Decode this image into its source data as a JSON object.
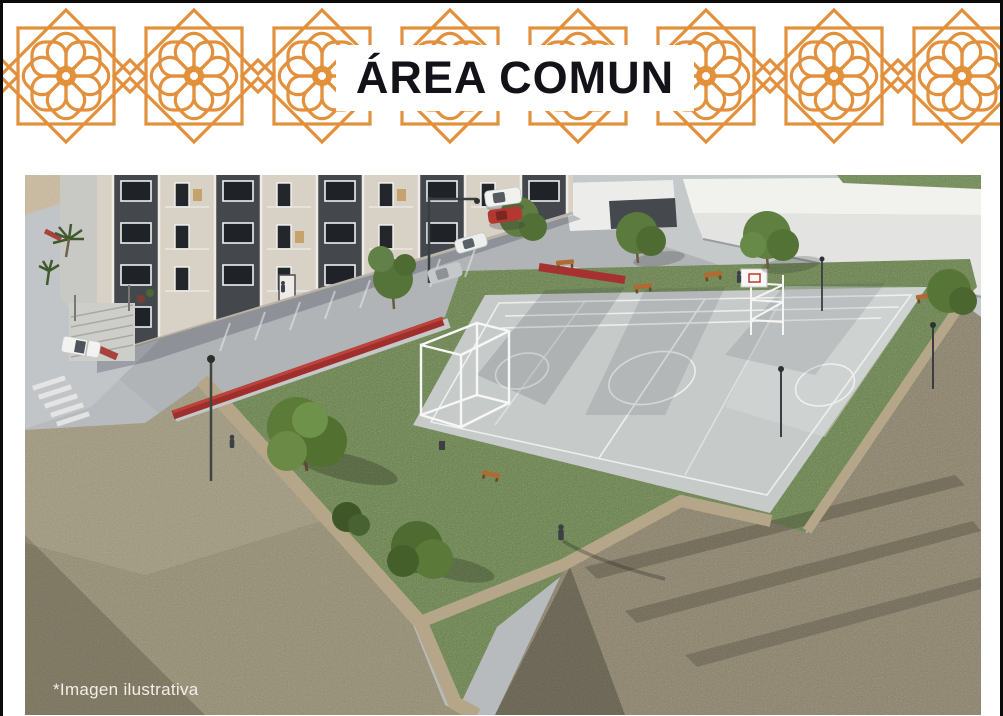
{
  "header": {
    "title": "ÁREA COMUN"
  },
  "image": {
    "caption": "*Imagen ilustrativa"
  },
  "palette": {
    "accent_orange": "#E3903C",
    "title_black": "#121218",
    "caption_white": "#F2EFE9",
    "pavement_gray": "#B7BBBD",
    "court_gray": "#C6CAC9",
    "grass_green": "#66833F",
    "dirt_khaki_left": "#948C6E",
    "dirt_khaki_right": "#8A8166",
    "hedge_red": "#A53230",
    "building_beige": "#D8D2C6",
    "building_dark_band": "#44474C",
    "warehouse_white": "#E9EAE7",
    "path_tan": "#B5A689"
  }
}
